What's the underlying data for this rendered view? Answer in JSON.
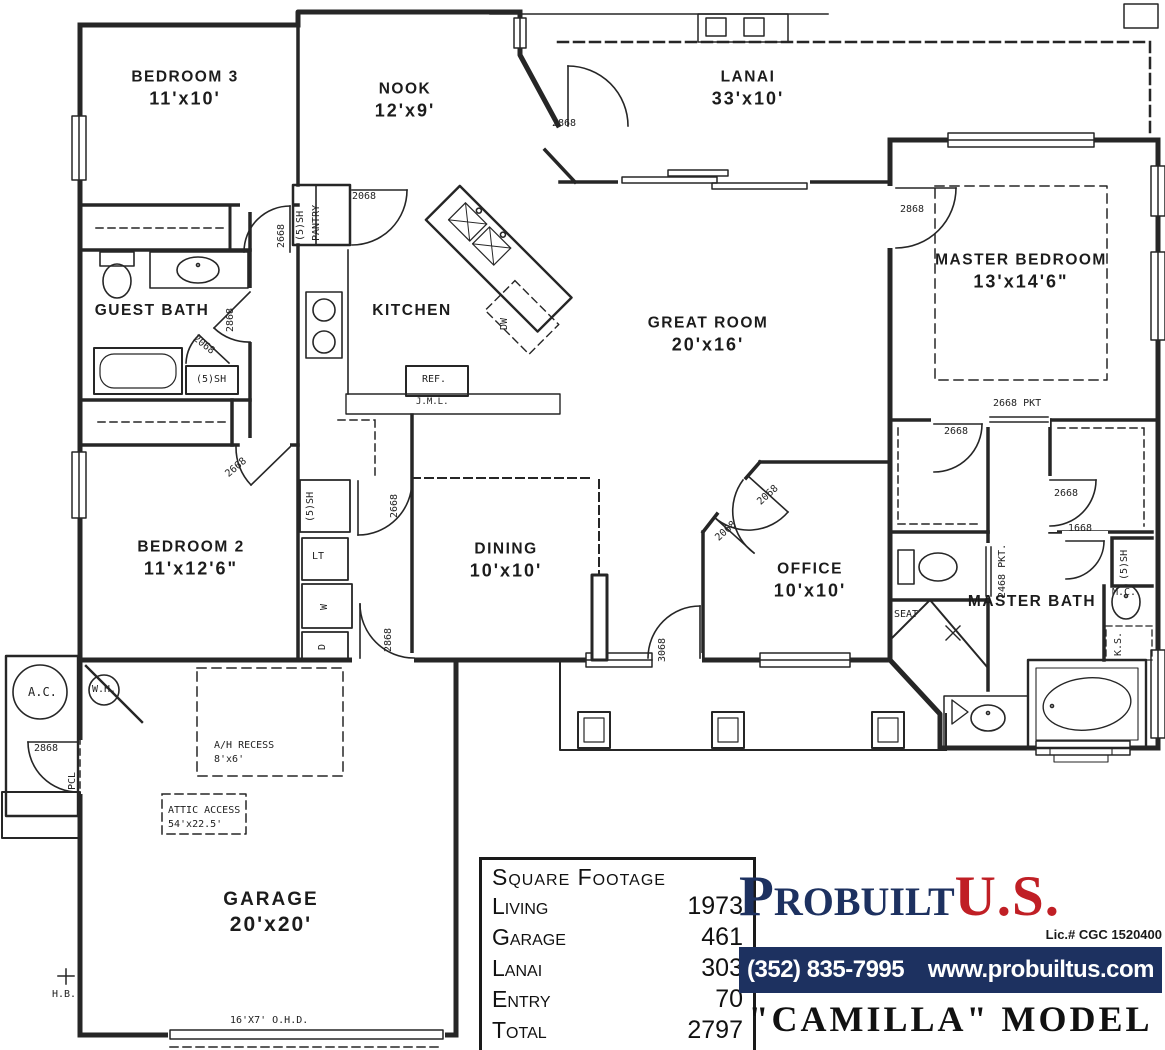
{
  "plan": {
    "rooms": [
      {
        "name": "BEDROOM 3",
        "dims": "11'x10'"
      },
      {
        "name": "NOOK",
        "dims": "12'x9'"
      },
      {
        "name": "LANAI",
        "dims": "33'x10'"
      },
      {
        "name": "MASTER BEDROOM",
        "dims": "13'x14'6\""
      },
      {
        "name": "GUEST BATH",
        "dims": ""
      },
      {
        "name": "KITCHEN",
        "dims": ""
      },
      {
        "name": "GREAT ROOM",
        "dims": "20'x16'"
      },
      {
        "name": "BEDROOM 2",
        "dims": "11'x12'6\""
      },
      {
        "name": "DINING",
        "dims": "10'x10'"
      },
      {
        "name": "OFFICE",
        "dims": "10'x10'"
      },
      {
        "name": "MASTER BATH",
        "dims": ""
      },
      {
        "name": "GARAGE",
        "dims": "20'x20'"
      }
    ],
    "door_sizes": {
      "d1668": "1668",
      "d2068": "2068",
      "d2668": "2668",
      "d2868": "2868",
      "d3068": "3068",
      "pkt2668": "2668 PKT",
      "pkt2468": "2468 PKT.",
      "shelves": "(5)SH"
    },
    "fixtures": {
      "pantry": "PANTRY",
      "dishwasher": "DW",
      "refrigerator": "REF.",
      "jml": "J.M.L.",
      "laundry_tub": "LT",
      "washer": "W",
      "dryer": "D",
      "seat": "SEAT",
      "medicine_cabinet": "M.C.",
      "knee_space": "K.S.",
      "ac": "A.C.",
      "water_heater": "W.H.",
      "pcl": "PCL",
      "hose_bib": "H.B.",
      "overhead_door": "16'X7' O.H.D.",
      "ah_recess": "A/H RECESS",
      "ah_recess_size": "8'x6'",
      "attic_access": "ATTIC ACCESS",
      "attic_access_size": "54'x22.5'"
    }
  },
  "square_footage": {
    "title": "Square Footage",
    "rows": [
      {
        "label": "Living",
        "value": "1973"
      },
      {
        "label": "Garage",
        "value": "461"
      },
      {
        "label": "Lanai",
        "value": "303"
      },
      {
        "label": "Entry",
        "value": "70"
      },
      {
        "label": "Total",
        "value": "2797"
      }
    ]
  },
  "branding": {
    "logo_name": "Probuilt",
    "logo_suffix": "U.S.",
    "license": "Lic.# CGC 1520400",
    "phone": "(352) 835-7995",
    "website": "www.probuiltus.com",
    "model_name": "\"CAMILLA\" MODEL",
    "colors": {
      "navy": "#1d3160",
      "red": "#c01f25",
      "ink": "#262626"
    }
  }
}
